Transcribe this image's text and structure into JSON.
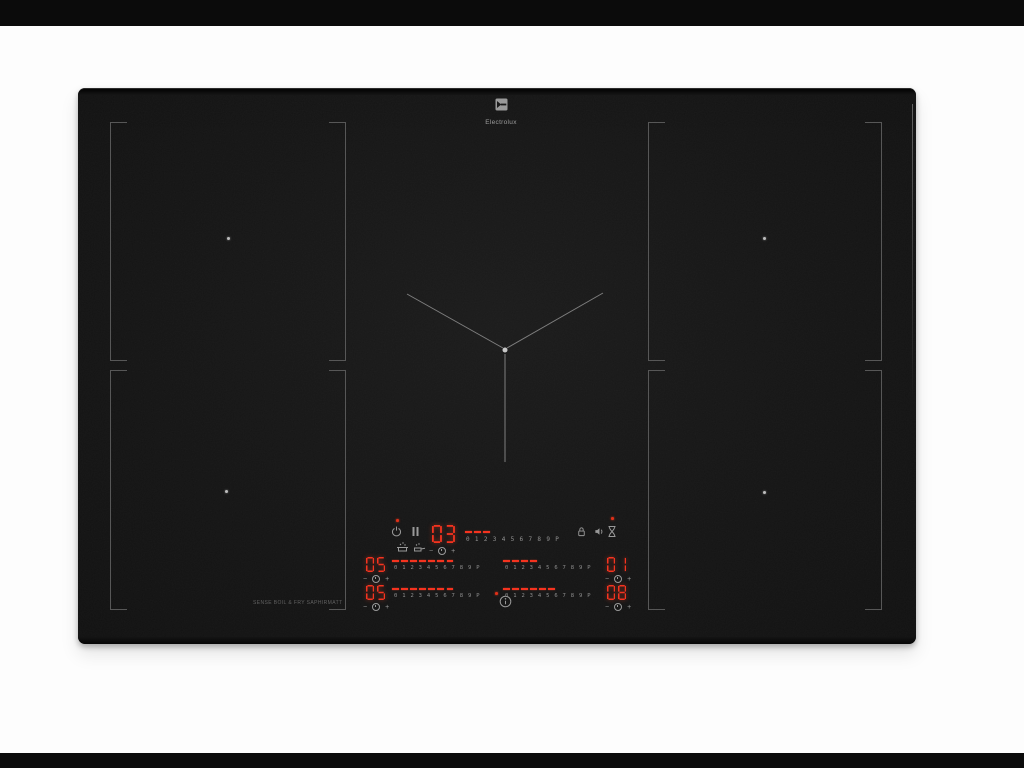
{
  "brand": {
    "wordmark": "Electrolux"
  },
  "hob": {
    "feature_text": "SENSE BOIL & FRY SAPHIRMATT",
    "slider_scale": "0 1 2 3 4 5 6 7 8 9 P",
    "glyphs": {
      "minus": "−",
      "plus": "+"
    },
    "controls": {
      "timer": {
        "value": "03",
        "dashes": 3
      },
      "left_top": {
        "value": "05",
        "dashes": 7
      },
      "right_top": {
        "value": "01",
        "dashes": 4
      },
      "left_bottom": {
        "value": "05",
        "dashes": 7
      },
      "right_bottom": {
        "value": "08",
        "dashes": 6
      }
    },
    "indicators": {
      "main_power": true,
      "timer_alert": true,
      "info_alert": true
    },
    "icons": [
      "power",
      "pause",
      "sense-boil",
      "sense-fry",
      "lock",
      "sound",
      "timer",
      "info",
      "zone-timer"
    ],
    "colors": {
      "display_red": "#f5331f",
      "indicator_red": "#e03018",
      "scale_gray": "#8f8f8f",
      "zone_line": "#575757",
      "glass_black": "#151515"
    }
  }
}
